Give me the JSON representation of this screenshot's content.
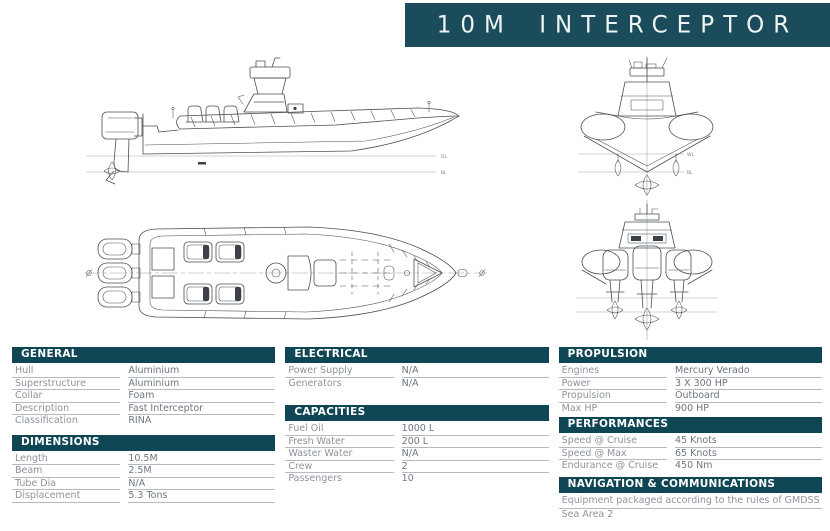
{
  "banner": {
    "title": "10M INTERCEPTOR"
  },
  "colors": {
    "banner_bg": "#1b4c5b",
    "section_header_bg": "#0f4654",
    "label_color": "#8d939c",
    "value_color": "#6e7680",
    "rule_color": "#b6bac0"
  },
  "drawings": {
    "side_view": {
      "waterline_upper": "DL",
      "waterline_lower": "BL"
    },
    "bow_view": {
      "waterline_upper": "WL",
      "waterline_lower": "BL"
    }
  },
  "spec_columns": [
    {
      "sections": [
        {
          "title": "GENERAL",
          "rows": [
            {
              "label": "Hull",
              "value": "Aluminium"
            },
            {
              "label": "Superstructure",
              "value": "Aluminium"
            },
            {
              "label": "Collar",
              "value": "Foam"
            },
            {
              "label": "Description",
              "value": "Fast Interceptor"
            },
            {
              "label": "Classification",
              "value": "RINA"
            }
          ]
        },
        {
          "title": "DIMENSIONS",
          "rows": [
            {
              "label": "Length",
              "value": "10.5M"
            },
            {
              "label": "Beam",
              "value": "2.5M"
            },
            {
              "label": "Tube Dia",
              "value": "N/A"
            },
            {
              "label": "Displacement",
              "value": "5.3 Tons"
            }
          ]
        }
      ]
    },
    {
      "sections": [
        {
          "title": "ELECTRICAL",
          "rows": [
            {
              "label": "Power Supply",
              "value": "N/A"
            },
            {
              "label": "Generators",
              "value": "N/A"
            }
          ]
        },
        {
          "title": "CAPACITIES",
          "rows": [
            {
              "label": "Fuel Oil",
              "value": "1000 L"
            },
            {
              "label": "Fresh Water",
              "value": "200 L"
            },
            {
              "label": "Waster Water",
              "value": "N/A"
            },
            {
              "label": "Crew",
              "value": "2"
            },
            {
              "label": "Passengers",
              "value": "10"
            }
          ]
        }
      ]
    },
    {
      "sections": [
        {
          "title": "PROPULSION",
          "rows": [
            {
              "label": "Engines",
              "value": "Mercury Verado"
            },
            {
              "label": "Power",
              "value": "3 X 300 HP"
            },
            {
              "label": "Propulsion",
              "value": "Outboard"
            },
            {
              "label": "Max HP",
              "value": "900 HP"
            }
          ]
        },
        {
          "title": "PERFORMANCES",
          "rows": [
            {
              "label": "Speed @ Cruise",
              "value": "45 Knots"
            },
            {
              "label": "Speed @ Max",
              "value": "65 Knots"
            },
            {
              "label": "Endurance @ Cruise",
              "value": "450 Nm"
            }
          ]
        },
        {
          "title": "NAVIGATION & COMMUNICATIONS",
          "rows": [
            {
              "text": "Equipment packaged according to the rules of GMDSS"
            },
            {
              "text": "Sea Area 2"
            }
          ]
        }
      ]
    }
  ]
}
